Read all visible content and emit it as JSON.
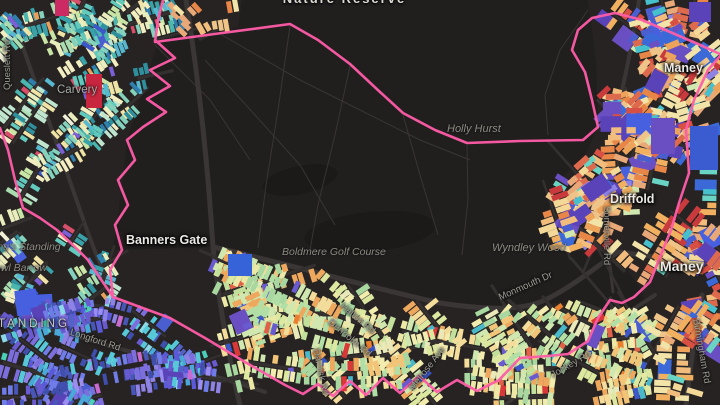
{
  "map": {
    "type": "building-choropleth-map",
    "background": "#272323",
    "park_fill": "#211e1e",
    "water_fill": "#1c1919",
    "boundary_color": "#ff5ca8",
    "road_color": "#3b3636",
    "minor_road_color": "#343030",
    "trail_color": "#413b3b",
    "palettes": {
      "cool": [
        "#4ab6ae",
        "#62c9bd",
        "#84d2bc",
        "#a9dcae",
        "#c9e5a6",
        "#e9edbd",
        "#f3eec1",
        "#39a2a8",
        "#2f8f9d",
        "#bfe5cf",
        "#efe3a5",
        "#57b8cf",
        "#2e7fae"
      ],
      "cool_accents": [
        "#e8a05c",
        "#d84f6a",
        "#7a5fd6",
        "#3b57c8",
        "#f0f0d8"
      ],
      "indigo": [
        "#5462c8",
        "#6a5ad0",
        "#7d6ede",
        "#4856b8",
        "#8e82e4",
        "#4aa8d8",
        "#56c8d8",
        "#9a8ef0",
        "#404fae",
        "#707de8",
        "#5a5ad8"
      ],
      "indigo_accents": [
        "#c86ad0",
        "#4ad0b8",
        "#8ad8e8"
      ],
      "warm_light": [
        "#f2ecae",
        "#ece8a6",
        "#dce8a0",
        "#c2e09c",
        "#a8d8a0",
        "#f4dc9a",
        "#f2c478",
        "#eda85e",
        "#e9e9b9",
        "#d0e8b0",
        "#b2dfa6"
      ],
      "warm_light_accents": [
        "#e06048",
        "#d83838",
        "#6a5ad0",
        "#49b8c8",
        "#3b57c8",
        "#e88030"
      ],
      "warm": [
        "#eda35a",
        "#f2bd7c",
        "#e88648",
        "#d84f44",
        "#c83a3c",
        "#f4d898",
        "#f2e4a8",
        "#e8a878",
        "#de6a4e",
        "#f0b060",
        "#efc489"
      ],
      "warm_accents": [
        "#4a5ed0",
        "#6a4fc2",
        "#3b6ad8",
        "#45c0cc",
        "#6ad4c4",
        "#8e82e4",
        "#d0e8b0"
      ],
      "blocks": [
        "#4a5ed0",
        "#6a4fc2",
        "#3b6ad8",
        "#5a43b8",
        "#4660e0"
      ]
    }
  },
  "labels": {
    "nature_reserve": "Nature Reserve",
    "carvery": "Carvery",
    "holly_hurst": "Holly Hurst",
    "maney_top": "Maney",
    "driffold": "Driffold",
    "somerville_rd": "Somerville Rd",
    "wyndley_wood": "Wyndley Wood",
    "monmouth_dr": "Monmouth Dr",
    "maney_bottom": "Maney",
    "banners_gate": "Banners Gate",
    "boldmere_golf_course": "Boldmere Golf Course",
    "kingstanding": "TANDING",
    "longford_rd": "Longford Rd",
    "kings_standing_line1": "King's Standing",
    "kings_standing_line2": "Bowl Barrow",
    "queslett_rd": "Queslett Rd",
    "darnick_rd": "Darnick Rd",
    "halton_rd": "Halton Rd",
    "denholm_rd": "Denholm Rd",
    "melrose_ave": "Melrose Ave",
    "jockey_rd": "Jockey Rd",
    "birmingham_rd": "Birmingham Rd"
  }
}
